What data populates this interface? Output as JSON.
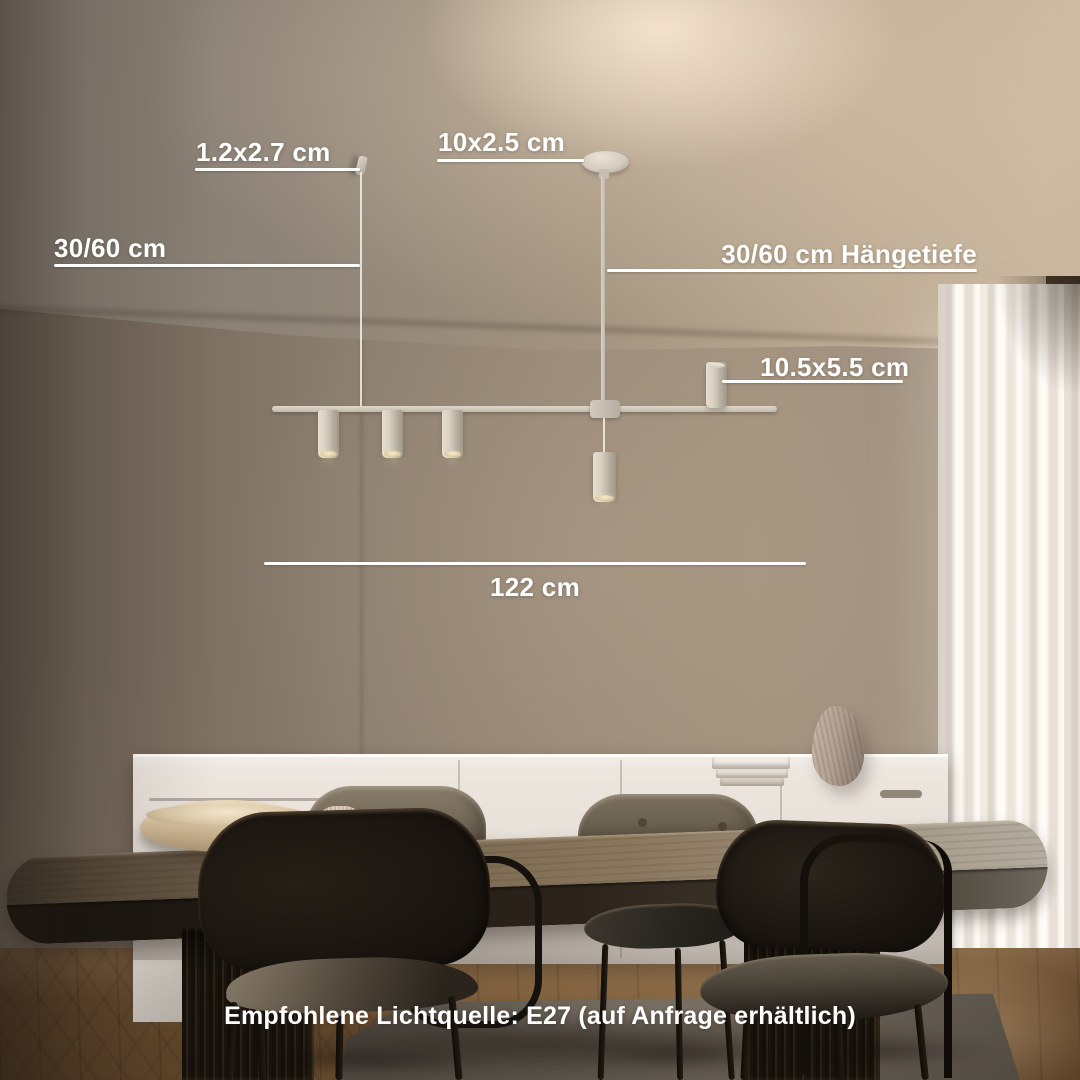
{
  "annotations": {
    "cable_mount_size": "1.2x2.7 cm",
    "canopy_size": "10x2.5 cm",
    "cable_length": "30/60 cm",
    "hanging_depth": "30/60 cm Hängetiefe",
    "spot_size": "10.5x5.5 cm",
    "total_width": "122 cm"
  },
  "footer": {
    "recommendation": "Empfohlene Lichtquelle: E27 (auf Anfrage erhältlich)"
  },
  "colors": {
    "annotation_text": "#ffffff",
    "dimension_line": "#ffffff",
    "lamp_body": "#d8d1c3",
    "ceiling_glow": "#e8d8c2",
    "wall_taupe": "#98897a",
    "curtain_white": "#f2ece3",
    "sideboard_white": "#e9e3dc",
    "table_wood": "#7e6c53",
    "table_edge_dark": "#211b14",
    "chair_black": "#1b1610",
    "chair_upholstery_beige": "#756a58",
    "floor_wood": "#7d5c38",
    "rug_grey": "#6e675c"
  }
}
